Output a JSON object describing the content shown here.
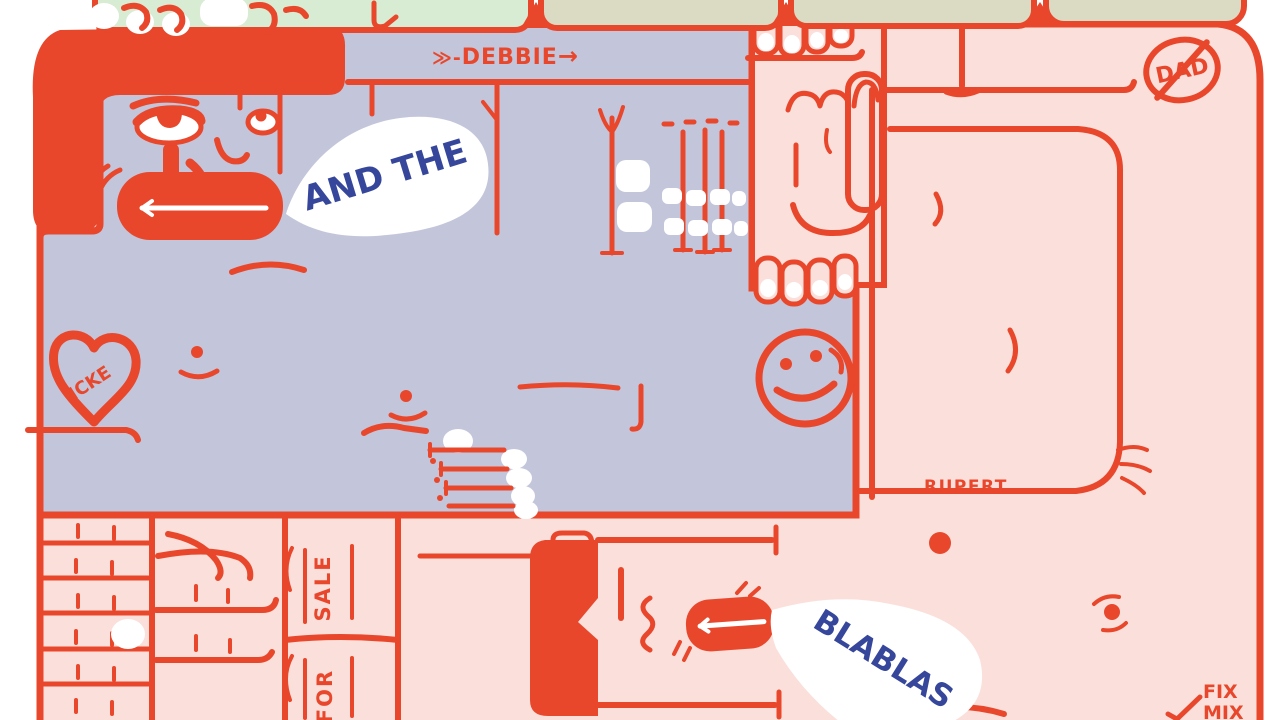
{
  "artwork": {
    "title": "cartoon figures illustration",
    "colors": {
      "red": "#e8472c",
      "lavender": "#c3c5da",
      "pink": "#fbdfda",
      "mint": "#d8ebd3",
      "sage": "#dbdac3",
      "blue": "#36479b",
      "white": "#ffffff"
    },
    "labels": {
      "debbie_prefix": "≫-",
      "debbie": "DEBBIE",
      "debbie_arrow": "→",
      "dad": "DAD",
      "icke": "ICKE",
      "rupert": "RUPERT",
      "sale": "SALE",
      "for": "FOR",
      "fix": "FIX",
      "mix": "MIX"
    },
    "speech": {
      "bubble1": "AND THE",
      "bubble2": "BLABLAS"
    }
  }
}
